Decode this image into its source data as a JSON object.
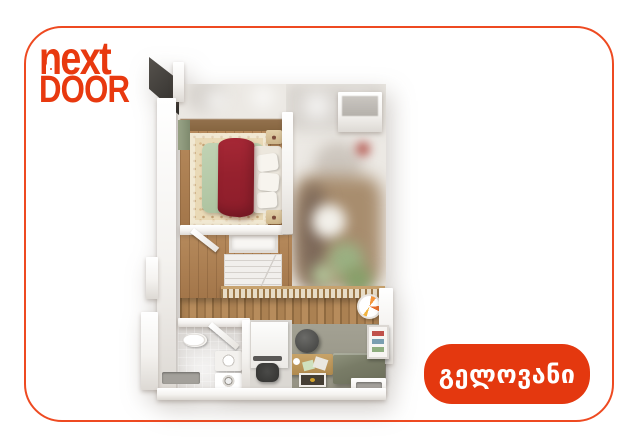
{
  "brand": {
    "wordmark_line1": "next",
    "wordmark_line2": "DOOR",
    "color": "#E8390F"
  },
  "card": {
    "background": "#FFFFFF",
    "border_color": "#EE4A21"
  },
  "badge": {
    "label": "გელოვანი",
    "background": "#E4380F",
    "text_color": "#FFFFFF"
  },
  "floorplan": {
    "type": "3d-floor-plan-render-top-down",
    "rooms": [
      "bedroom",
      "bathroom",
      "hallway-with-stairs",
      "workspace-living-area",
      "blurred-adjacent-living-area"
    ],
    "objects": [
      "double-bed",
      "red-blanket",
      "area-rug",
      "nightstand",
      "nightstand",
      "wardrobe",
      "stairs",
      "wood-railing",
      "plank-accent-wall",
      "toilet",
      "sink",
      "washing-machine",
      "desk",
      "office-chair",
      "monitor",
      "stool",
      "console-table",
      "wall-clock",
      "bookshelf",
      "sofa-platform",
      "floor-mat",
      "ceiling-lights",
      "floor-vents"
    ],
    "palette": {
      "wood_floor": "#B0804F",
      "plank_wall": "#A57A4C",
      "rug": "#E9DAB6",
      "duvet": "#B6CAA9",
      "blanket": "#9C2130",
      "bath_floor": "#B1C4D4",
      "gray_floor": "#9C9A8C",
      "sofa": "#75785F",
      "wall": "#FFFFFF"
    }
  }
}
